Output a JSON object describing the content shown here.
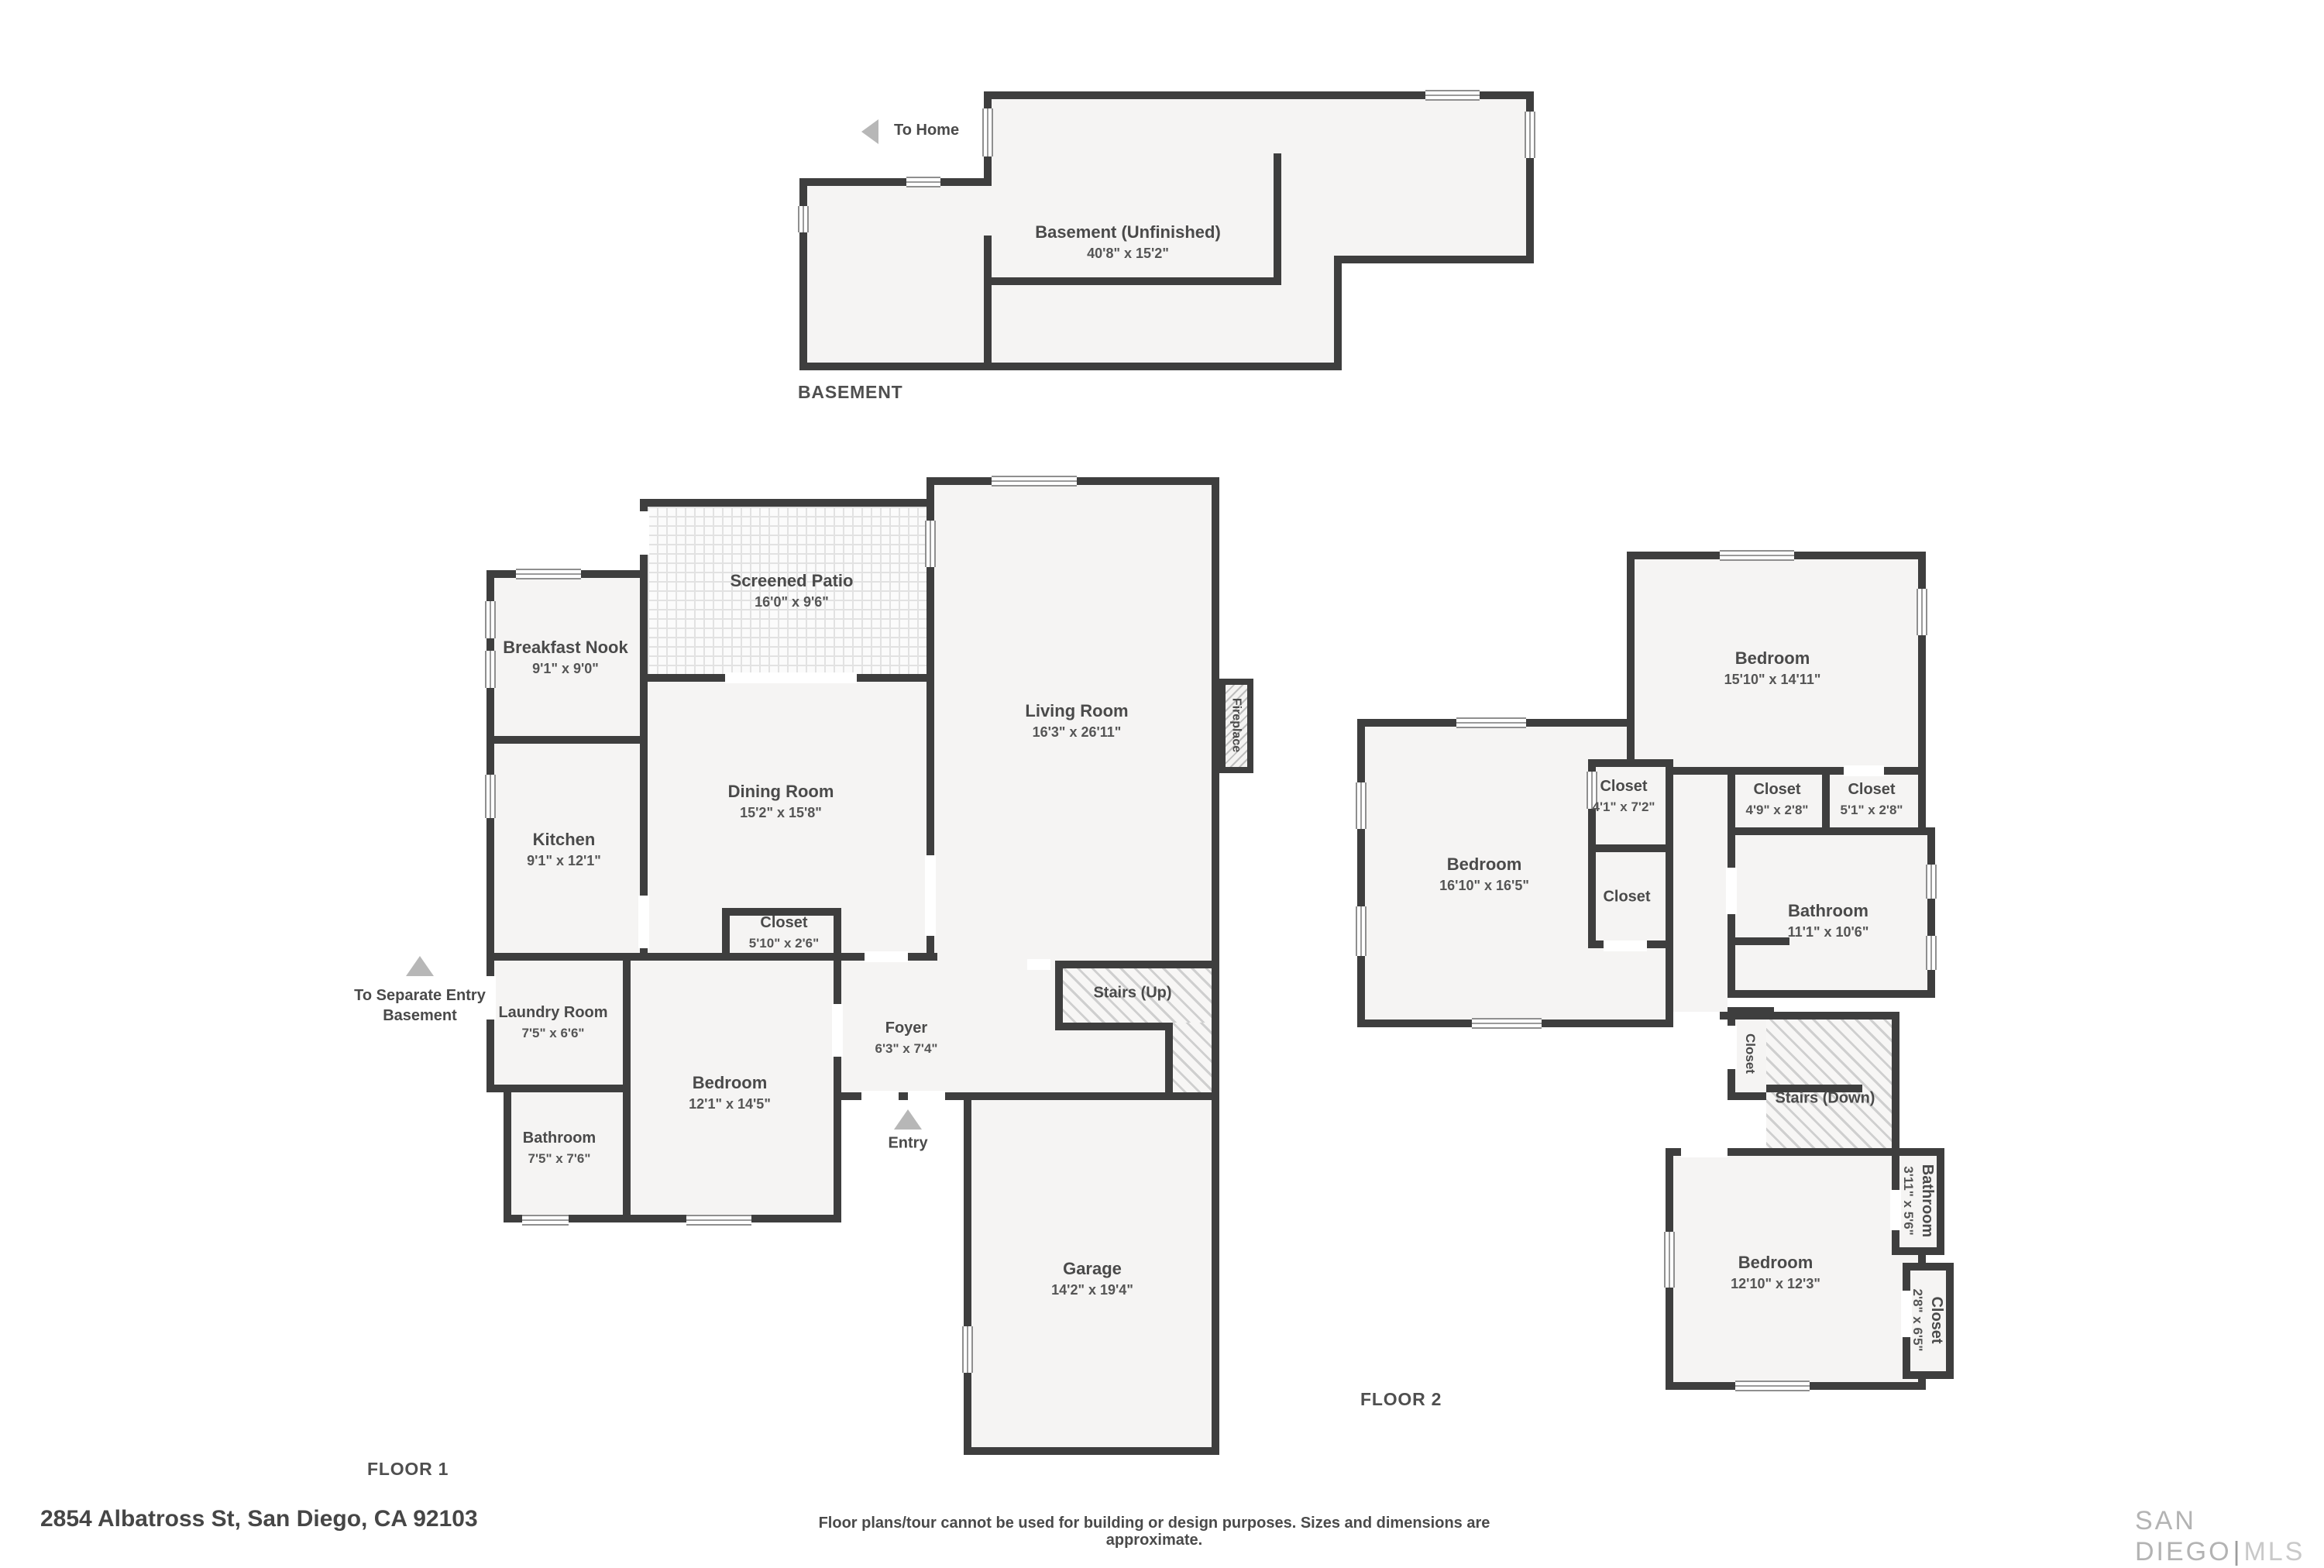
{
  "basement": {
    "caption": "BASEMENT",
    "to_home_label": "To Home",
    "room": {
      "name": "Basement (Unfinished)",
      "dims": "40'8\" x 15'2\""
    }
  },
  "floor1": {
    "caption": "FLOOR 1",
    "separate_entry_label": "To Separate Entry Basement",
    "entry_label": "Entry",
    "stairs_label": "Stairs (Up)",
    "fireplace_label": "Fireplace",
    "rooms": {
      "patio": {
        "name": "Screened Patio",
        "dims": "16'0\" x 9'6\""
      },
      "nook": {
        "name": "Breakfast Nook",
        "dims": "9'1\" x 9'0\""
      },
      "living": {
        "name": "Living Room",
        "dims": "16'3\" x 26'11\""
      },
      "dining": {
        "name": "Dining Room",
        "dims": "15'2\" x 15'8\""
      },
      "kitchen": {
        "name": "Kitchen",
        "dims": "9'1\" x 12'1\""
      },
      "closet": {
        "name": "Closet",
        "dims": "5'10\" x 2'6\""
      },
      "laundry": {
        "name": "Laundry Room",
        "dims": "7'5\" x 6'6\""
      },
      "bedroom": {
        "name": "Bedroom",
        "dims": "12'1\" x 14'5\""
      },
      "bathroom": {
        "name": "Bathroom",
        "dims": "7'5\" x 7'6\""
      },
      "foyer": {
        "name": "Foyer",
        "dims": "6'3\" x 7'4\""
      },
      "garage": {
        "name": "Garage",
        "dims": "14'2\" x 19'4\""
      }
    }
  },
  "floor2": {
    "caption": "FLOOR 2",
    "stairs_label": "Stairs (Down)",
    "rooms": {
      "bedroom_top": {
        "name": "Bedroom",
        "dims": "15'10\" x 14'11\""
      },
      "bedroom_left": {
        "name": "Bedroom",
        "dims": "16'10\" x 16'5\""
      },
      "closet_a": {
        "name": "Closet",
        "dims": "4'1\" x 7'2\""
      },
      "closet_b": {
        "name": "Closet"
      },
      "closet_c": {
        "name": "Closet",
        "dims": "4'9\" x 2'8\""
      },
      "closet_d": {
        "name": "Closet",
        "dims": "5'1\" x 2'8\""
      },
      "bathroom": {
        "name": "Bathroom",
        "dims": "11'1\" x 10'6\""
      },
      "closet_stairs": {
        "name": "Closet"
      },
      "bedroom_bottom": {
        "name": "Bedroom",
        "dims": "12'10\" x 12'3\""
      },
      "bathroom_small": {
        "name": "Bathroom",
        "dims": "3'11\" x 5'6\""
      },
      "closet_small": {
        "name": "Closet",
        "dims": "2'8\" x 6'5\""
      }
    }
  },
  "footer": {
    "address": "2854 Albatross St, San Diego, CA 92103",
    "disclaimer": "Floor plans/tour cannot be used for building or design purposes. Sizes and dimensions are approximate.",
    "brand_primary": "SAN DIEGO",
    "brand_divider": "|",
    "brand_suffix": "MLS"
  }
}
